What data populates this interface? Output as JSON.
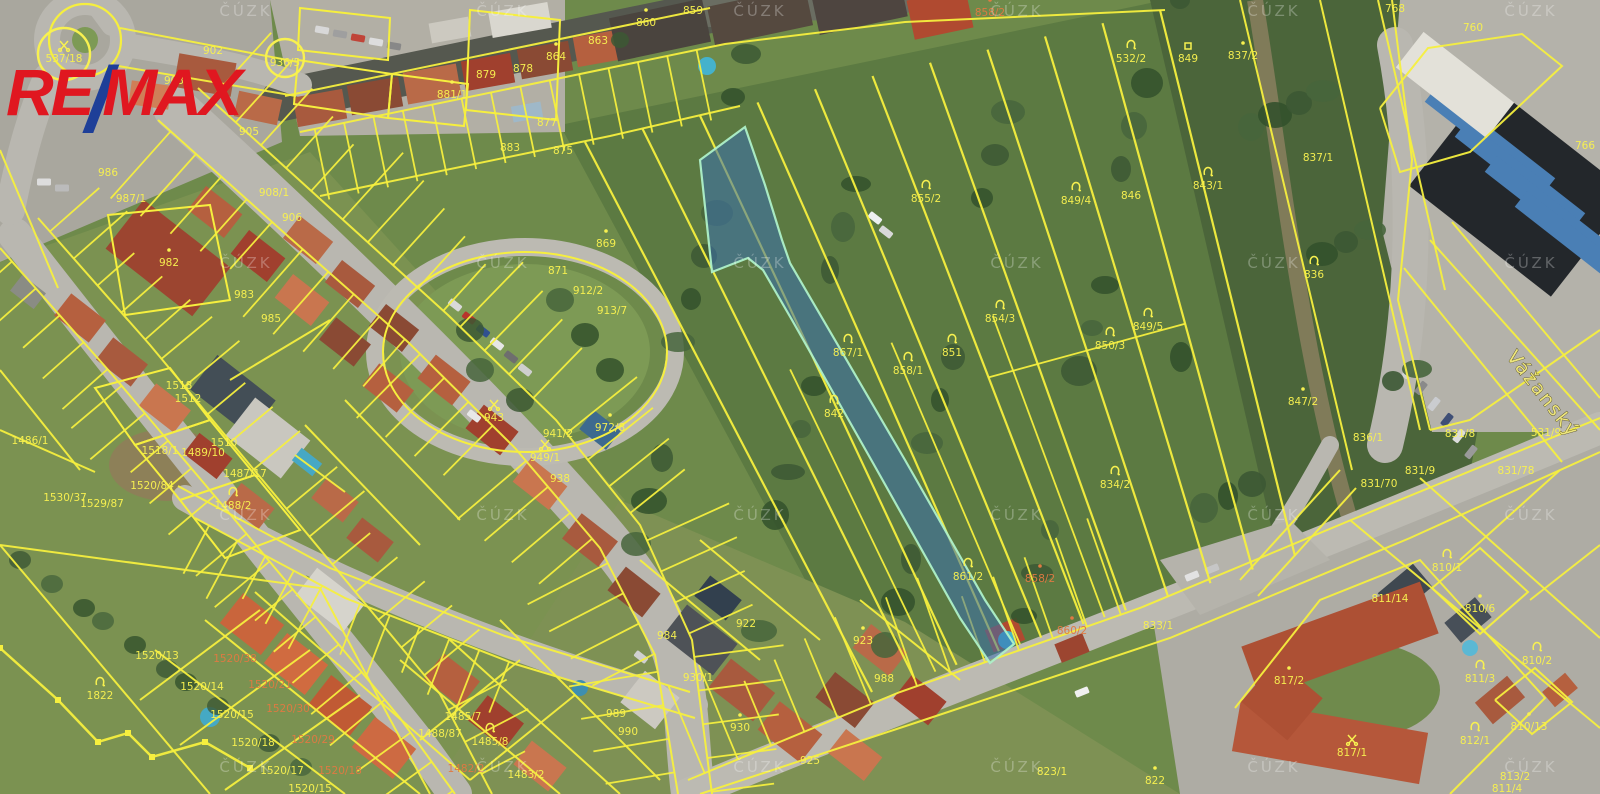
{
  "branding": {
    "re": "RE",
    "slash": "/",
    "max": "MAX"
  },
  "map": {
    "street_label": "Vážanský",
    "watermark_text": "ČÚZK",
    "highlighted_parcel_number": "867/1",
    "colors": {
      "cadastral_line": "#f6ef3e",
      "highlight_fill": "#3a6fae",
      "highlight_stroke": "#aef0c8",
      "label_yellow": "#f8f150",
      "label_orange": "#e07a42",
      "logo_red": "#e01720",
      "logo_blue": "#1e3f98",
      "watermark": "#ffffff"
    },
    "parcel_labels": [
      {
        "text": "537/18",
        "x": 64,
        "y": 58,
        "icon": "scissors",
        "ring": 26
      },
      {
        "text": "936/5",
        "x": 285,
        "y": 62,
        "ring": 19
      },
      {
        "text": "902",
        "x": 213,
        "y": 50
      },
      {
        "text": "903",
        "x": 174,
        "y": 80
      },
      {
        "text": "905",
        "x": 249,
        "y": 131
      },
      {
        "text": "986",
        "x": 108,
        "y": 172
      },
      {
        "text": "987/1",
        "x": 131,
        "y": 198
      },
      {
        "text": "982",
        "x": 169,
        "y": 262,
        "icon": "dot"
      },
      {
        "text": "908/1",
        "x": 274,
        "y": 192
      },
      {
        "text": "906",
        "x": 292,
        "y": 217
      },
      {
        "text": "983",
        "x": 244,
        "y": 294
      },
      {
        "text": "985",
        "x": 271,
        "y": 318
      },
      {
        "text": "859",
        "x": 693,
        "y": 10
      },
      {
        "text": "860",
        "x": 646,
        "y": 22,
        "icon": "dot"
      },
      {
        "text": "863",
        "x": 598,
        "y": 40
      },
      {
        "text": "864",
        "x": 556,
        "y": 56,
        "icon": "dot"
      },
      {
        "text": "878",
        "x": 523,
        "y": 68
      },
      {
        "text": "879",
        "x": 486,
        "y": 74
      },
      {
        "text": "881/1",
        "x": 452,
        "y": 94,
        "icon": "dot"
      },
      {
        "text": "877",
        "x": 547,
        "y": 122
      },
      {
        "text": "883",
        "x": 510,
        "y": 147
      },
      {
        "text": "875",
        "x": 563,
        "y": 150
      },
      {
        "text": "869",
        "x": 606,
        "y": 243,
        "icon": "dot"
      },
      {
        "text": "871",
        "x": 558,
        "y": 270
      },
      {
        "text": "912/2",
        "x": 588,
        "y": 290
      },
      {
        "text": "913/7",
        "x": 612,
        "y": 310
      },
      {
        "text": "943",
        "x": 494,
        "y": 417,
        "icon": "scissors"
      },
      {
        "text": "949/1",
        "x": 545,
        "y": 457,
        "icon": "scissors"
      },
      {
        "text": "941/2",
        "x": 558,
        "y": 433
      },
      {
        "text": "938",
        "x": 560,
        "y": 478
      },
      {
        "text": "972/8",
        "x": 610,
        "y": 427,
        "icon": "dot"
      },
      {
        "text": "858/2",
        "x": 990,
        "y": 12,
        "icon": "dot",
        "color": "orange"
      },
      {
        "text": "532/2",
        "x": 1131,
        "y": 58,
        "icon": "horn"
      },
      {
        "text": "849",
        "x": 1188,
        "y": 58,
        "icon": "square"
      },
      {
        "text": "837/2",
        "x": 1243,
        "y": 55,
        "icon": "dot"
      },
      {
        "text": "766",
        "x": 1585,
        "y": 145
      },
      {
        "text": "768",
        "x": 1395,
        "y": 8
      },
      {
        "text": "760",
        "x": 1473,
        "y": 27
      },
      {
        "text": "855/2",
        "x": 926,
        "y": 198,
        "icon": "horn"
      },
      {
        "text": "854/3",
        "x": 1000,
        "y": 318,
        "icon": "horn"
      },
      {
        "text": "867/1",
        "x": 848,
        "y": 352,
        "icon": "horn"
      },
      {
        "text": "858/1",
        "x": 908,
        "y": 370,
        "icon": "horn"
      },
      {
        "text": "851",
        "x": 952,
        "y": 352,
        "icon": "horn"
      },
      {
        "text": "842",
        "x": 834,
        "y": 413,
        "icon": "horn"
      },
      {
        "text": "861/2",
        "x": 968,
        "y": 576,
        "icon": "horn"
      },
      {
        "text": "858/2",
        "x": 1040,
        "y": 578,
        "icon": "dot",
        "color": "orange"
      },
      {
        "text": "834/2",
        "x": 1115,
        "y": 484,
        "icon": "horn"
      },
      {
        "text": "849/4",
        "x": 1076,
        "y": 200,
        "icon": "horn"
      },
      {
        "text": "846",
        "x": 1131,
        "y": 195
      },
      {
        "text": "843/1",
        "x": 1208,
        "y": 185,
        "icon": "horn"
      },
      {
        "text": "837/1",
        "x": 1318,
        "y": 157
      },
      {
        "text": "849/5",
        "x": 1148,
        "y": 326,
        "icon": "horn"
      },
      {
        "text": "850/3",
        "x": 1110,
        "y": 345,
        "icon": "horn"
      },
      {
        "text": "836",
        "x": 1314,
        "y": 274,
        "icon": "horn"
      },
      {
        "text": "847/2",
        "x": 1303,
        "y": 401,
        "icon": "dot"
      },
      {
        "text": "836/1",
        "x": 1368,
        "y": 437
      },
      {
        "text": "831/9",
        "x": 1420,
        "y": 470
      },
      {
        "text": "831/70",
        "x": 1379,
        "y": 483
      },
      {
        "text": "831/8",
        "x": 1460,
        "y": 433
      },
      {
        "text": "531/9",
        "x": 1546,
        "y": 432
      },
      {
        "text": "831/78",
        "x": 1516,
        "y": 470
      },
      {
        "text": "810/1",
        "x": 1447,
        "y": 567,
        "icon": "horn"
      },
      {
        "text": "811/14",
        "x": 1390,
        "y": 598
      },
      {
        "text": "810/6",
        "x": 1480,
        "y": 608,
        "icon": "dot"
      },
      {
        "text": "810/2",
        "x": 1537,
        "y": 660,
        "icon": "horn"
      },
      {
        "text": "811/3",
        "x": 1480,
        "y": 678,
        "icon": "horn"
      },
      {
        "text": "810/13",
        "x": 1529,
        "y": 726,
        "icon": "dot"
      },
      {
        "text": "812/1",
        "x": 1475,
        "y": 740,
        "icon": "horn"
      },
      {
        "text": "813/2",
        "x": 1515,
        "y": 776
      },
      {
        "text": "811/4",
        "x": 1507,
        "y": 788
      },
      {
        "text": "817/2",
        "x": 1289,
        "y": 680,
        "icon": "dot"
      },
      {
        "text": "817/1",
        "x": 1352,
        "y": 752,
        "icon": "scissors"
      },
      {
        "text": "860/2",
        "x": 1072,
        "y": 630,
        "icon": "dot",
        "color": "orange"
      },
      {
        "text": "833/1",
        "x": 1158,
        "y": 625
      },
      {
        "text": "823/1",
        "x": 1052,
        "y": 771
      },
      {
        "text": "822",
        "x": 1155,
        "y": 780,
        "icon": "dot"
      },
      {
        "text": "930",
        "x": 740,
        "y": 727,
        "icon": "dot"
      },
      {
        "text": "925",
        "x": 810,
        "y": 760
      },
      {
        "text": "923",
        "x": 863,
        "y": 640,
        "icon": "dot"
      },
      {
        "text": "988",
        "x": 884,
        "y": 678
      },
      {
        "text": "930/1",
        "x": 698,
        "y": 677
      },
      {
        "text": "984",
        "x": 667,
        "y": 635
      },
      {
        "text": "922",
        "x": 746,
        "y": 623
      },
      {
        "text": "1822",
        "x": 100,
        "y": 695,
        "icon": "horn"
      },
      {
        "text": "1520/13",
        "x": 157,
        "y": 655
      },
      {
        "text": "1520/38",
        "x": 235,
        "y": 658,
        "color": "orange"
      },
      {
        "text": "1520/14",
        "x": 202,
        "y": 686
      },
      {
        "text": "1520/21",
        "x": 270,
        "y": 684,
        "color": "orange"
      },
      {
        "text": "1520/15",
        "x": 232,
        "y": 714
      },
      {
        "text": "1520/30",
        "x": 288,
        "y": 708,
        "color": "orange"
      },
      {
        "text": "1520/18",
        "x": 253,
        "y": 742
      },
      {
        "text": "1520/29",
        "x": 313,
        "y": 739,
        "color": "orange"
      },
      {
        "text": "1520/17",
        "x": 282,
        "y": 770
      },
      {
        "text": "1520/18",
        "x": 340,
        "y": 770,
        "color": "orange"
      },
      {
        "text": "1520/15",
        "x": 310,
        "y": 788
      },
      {
        "text": "1518",
        "x": 179,
        "y": 385
      },
      {
        "text": "1512",
        "x": 188,
        "y": 398
      },
      {
        "text": "1518/1",
        "x": 160,
        "y": 450
      },
      {
        "text": "1510",
        "x": 224,
        "y": 442
      },
      {
        "text": "1489/10",
        "x": 203,
        "y": 452
      },
      {
        "text": "1487/17",
        "x": 245,
        "y": 473
      },
      {
        "text": "1488/2",
        "x": 233,
        "y": 505,
        "icon": "horn"
      },
      {
        "text": "1529/87",
        "x": 102,
        "y": 503
      },
      {
        "text": "1520/84",
        "x": 152,
        "y": 485
      },
      {
        "text": "1486/1",
        "x": 30,
        "y": 440
      },
      {
        "text": "1530/37",
        "x": 65,
        "y": 497
      },
      {
        "text": "1485/7",
        "x": 463,
        "y": 716
      },
      {
        "text": "1485/8",
        "x": 490,
        "y": 741,
        "icon": "horn"
      },
      {
        "text": "1488/87",
        "x": 440,
        "y": 733
      },
      {
        "text": "1482/2",
        "x": 466,
        "y": 768,
        "color": "orange"
      },
      {
        "text": "1483/2",
        "x": 526,
        "y": 774
      },
      {
        "text": "990",
        "x": 628,
        "y": 731
      },
      {
        "text": "989",
        "x": 616,
        "y": 713
      }
    ]
  }
}
